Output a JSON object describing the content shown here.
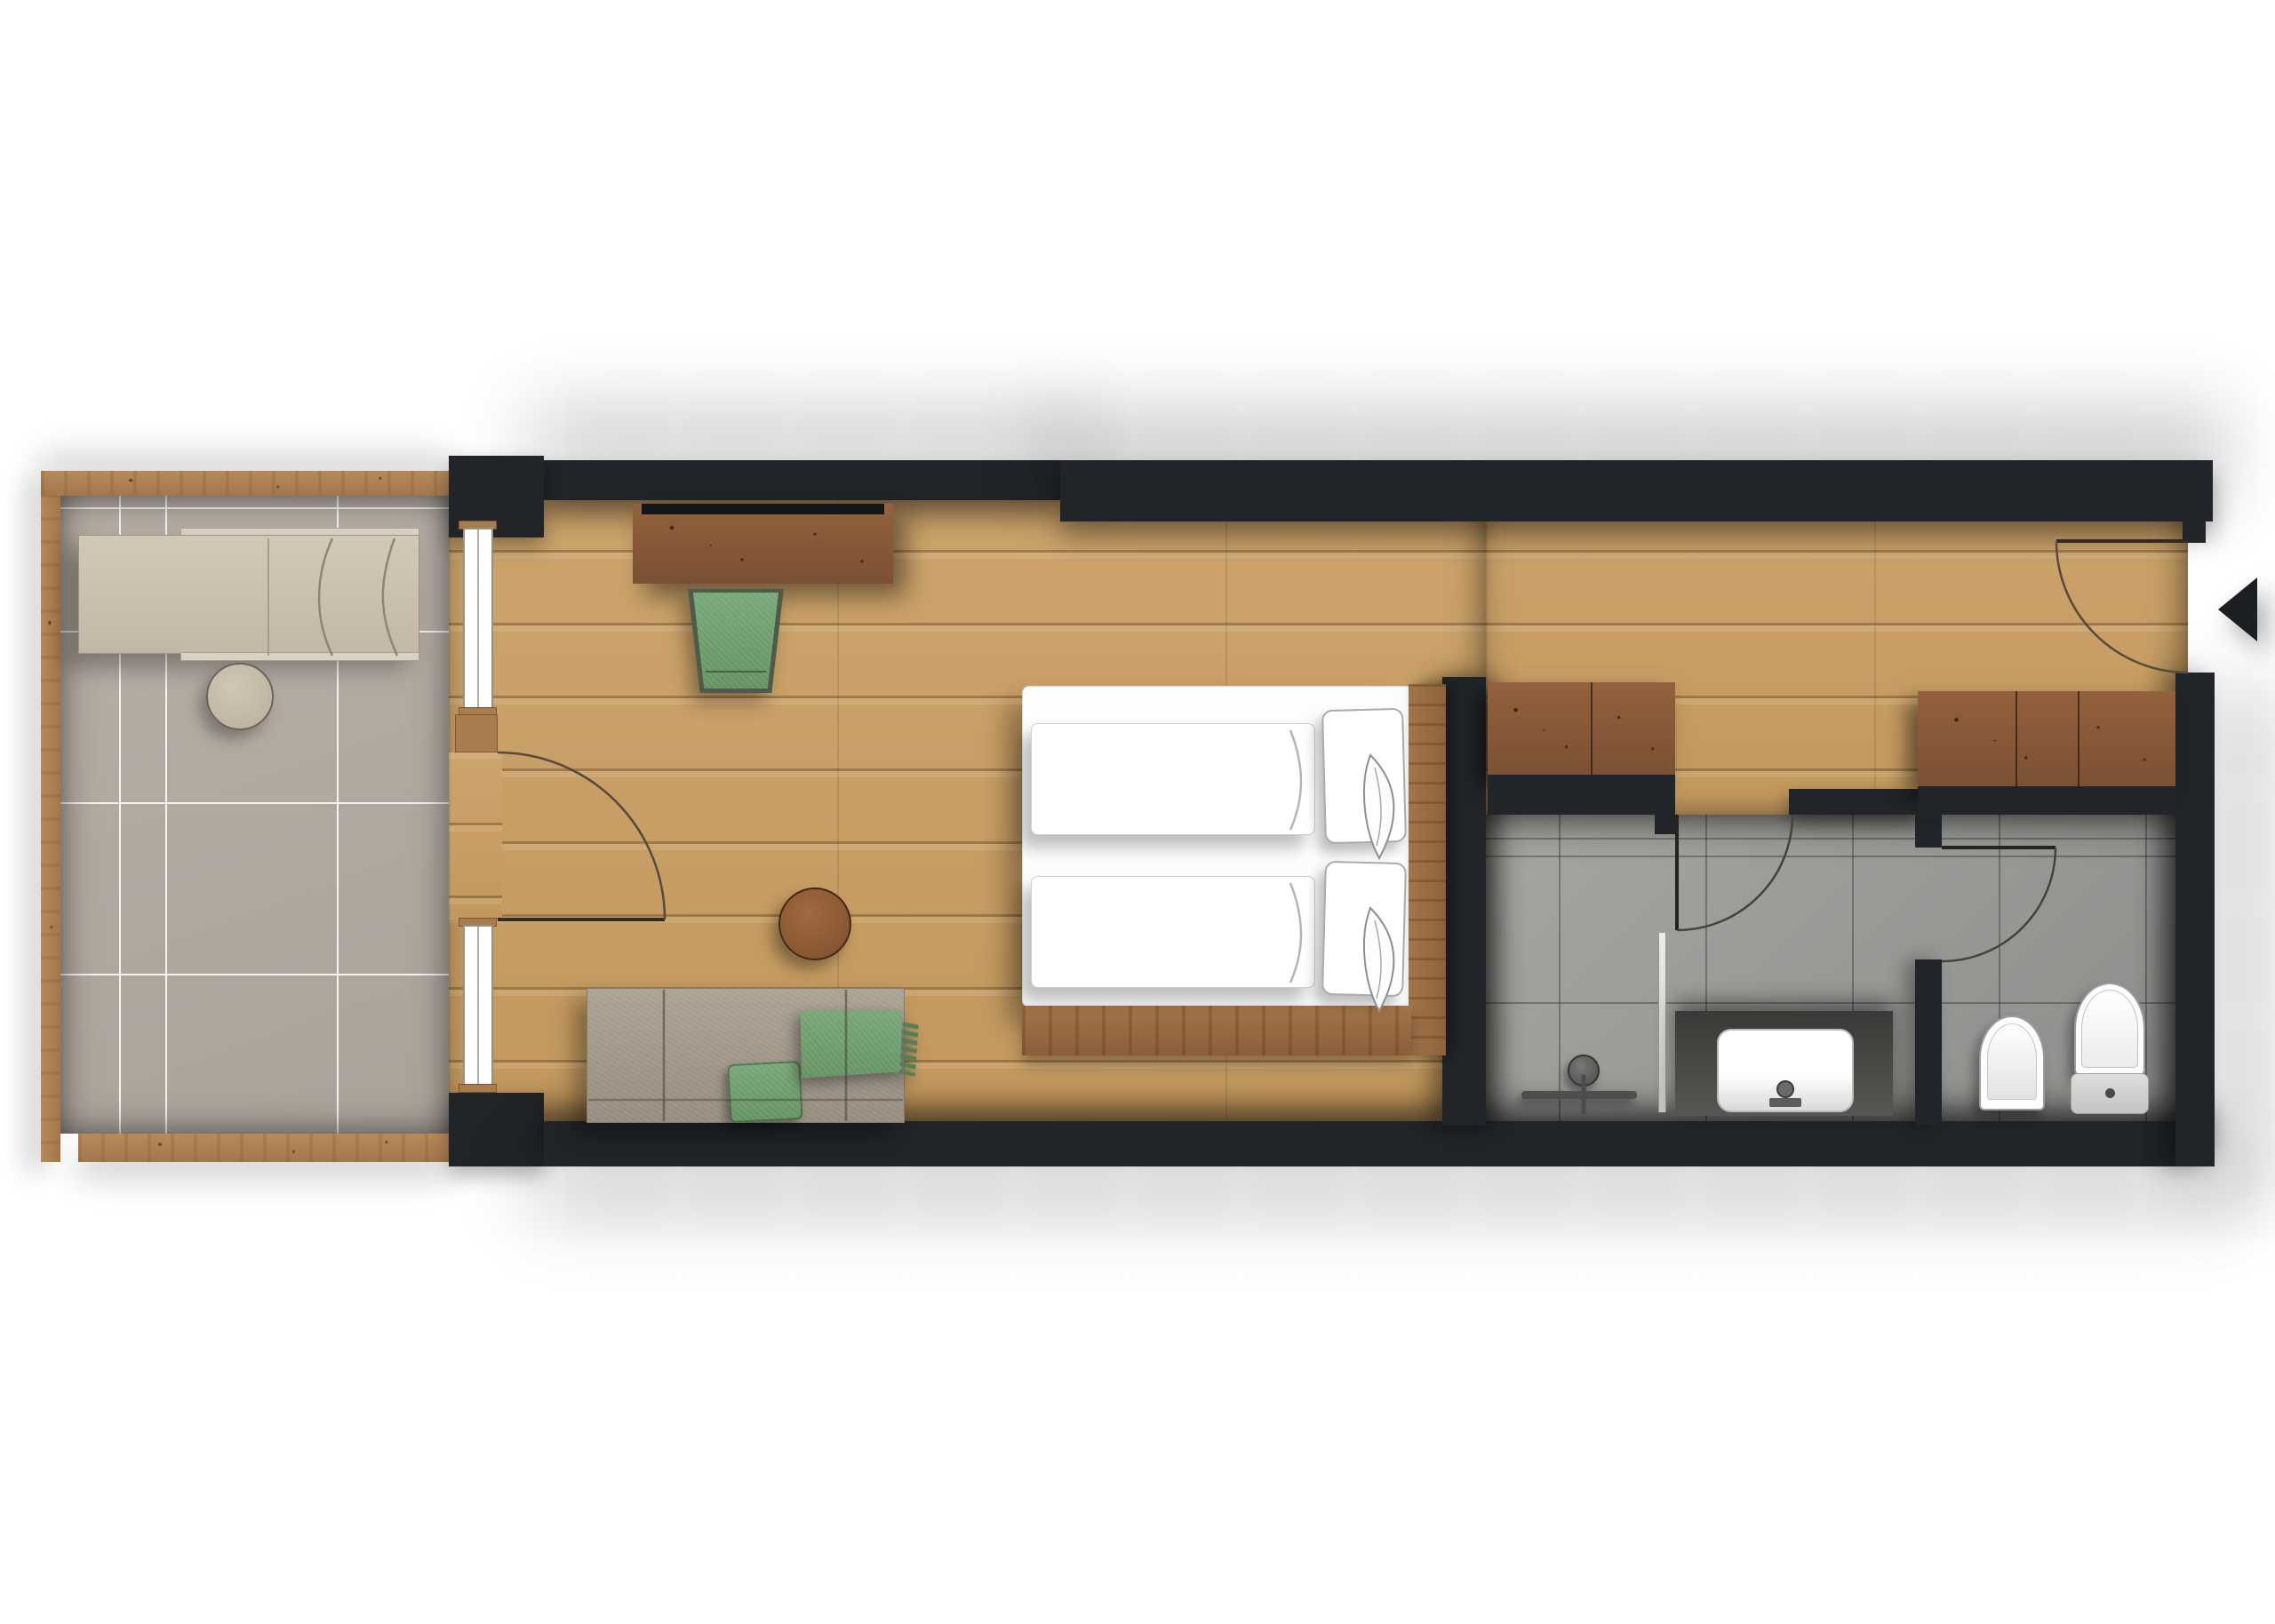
{
  "meta": {
    "kind": "top-down architectural floor plan rendering of a hotel room",
    "orientation": "balcony left, bedroom center, bathroom and WC right, entrance door in right wall"
  },
  "rooms": {
    "balcony": "Balcony terrace",
    "bedroom": "Bedroom and lounge",
    "hallway": "Entrance hallway",
    "bathroom": "Shower bathroom",
    "wc": "WC room"
  },
  "furniture": {
    "lounger": "Sun lounger",
    "balcony_table": "Round balcony side table",
    "desk": "Dark wood sideboard desk",
    "chair": "Green upholstered armchair",
    "bed": "Double bed with two duvets and two pillows",
    "side_table": "Round dark wood stool",
    "sofa": "Daybed sofa",
    "green_pillow": "Green cushion",
    "green_throw": "Green fringed throw",
    "wardrobe_left": "Built-in wardrobe",
    "wardrobe_right": "Built-in wardrobe"
  },
  "fixtures": {
    "shower": "Walk-in shower with rain head",
    "shower_glass": "Shower glass screen",
    "vanity": "Dark vanity counter with white basin",
    "toilet": "Toilet with cistern",
    "bidet": "Bidet"
  },
  "doors": {
    "entrance": "Entrance door with swing arc and direction arrow",
    "balcony_door": "Balcony door with swing arc",
    "bathroom_door": "Bathroom door with swing arc",
    "wc_door": "WC door with swing arc"
  },
  "colors": {
    "wall": "#212428",
    "oak_floor": "#c7a065",
    "trim_wood": "#ad8154",
    "dark_wood": "#8a5a3a",
    "balcony_tile": "#b3aba2",
    "bath_tile": "#9c9c99",
    "accent_green": "#6f9e6e",
    "sofa_gray": "#a39a8e",
    "lounger_beige": "#cdc3b1",
    "fixture_white": "#ffffff"
  }
}
